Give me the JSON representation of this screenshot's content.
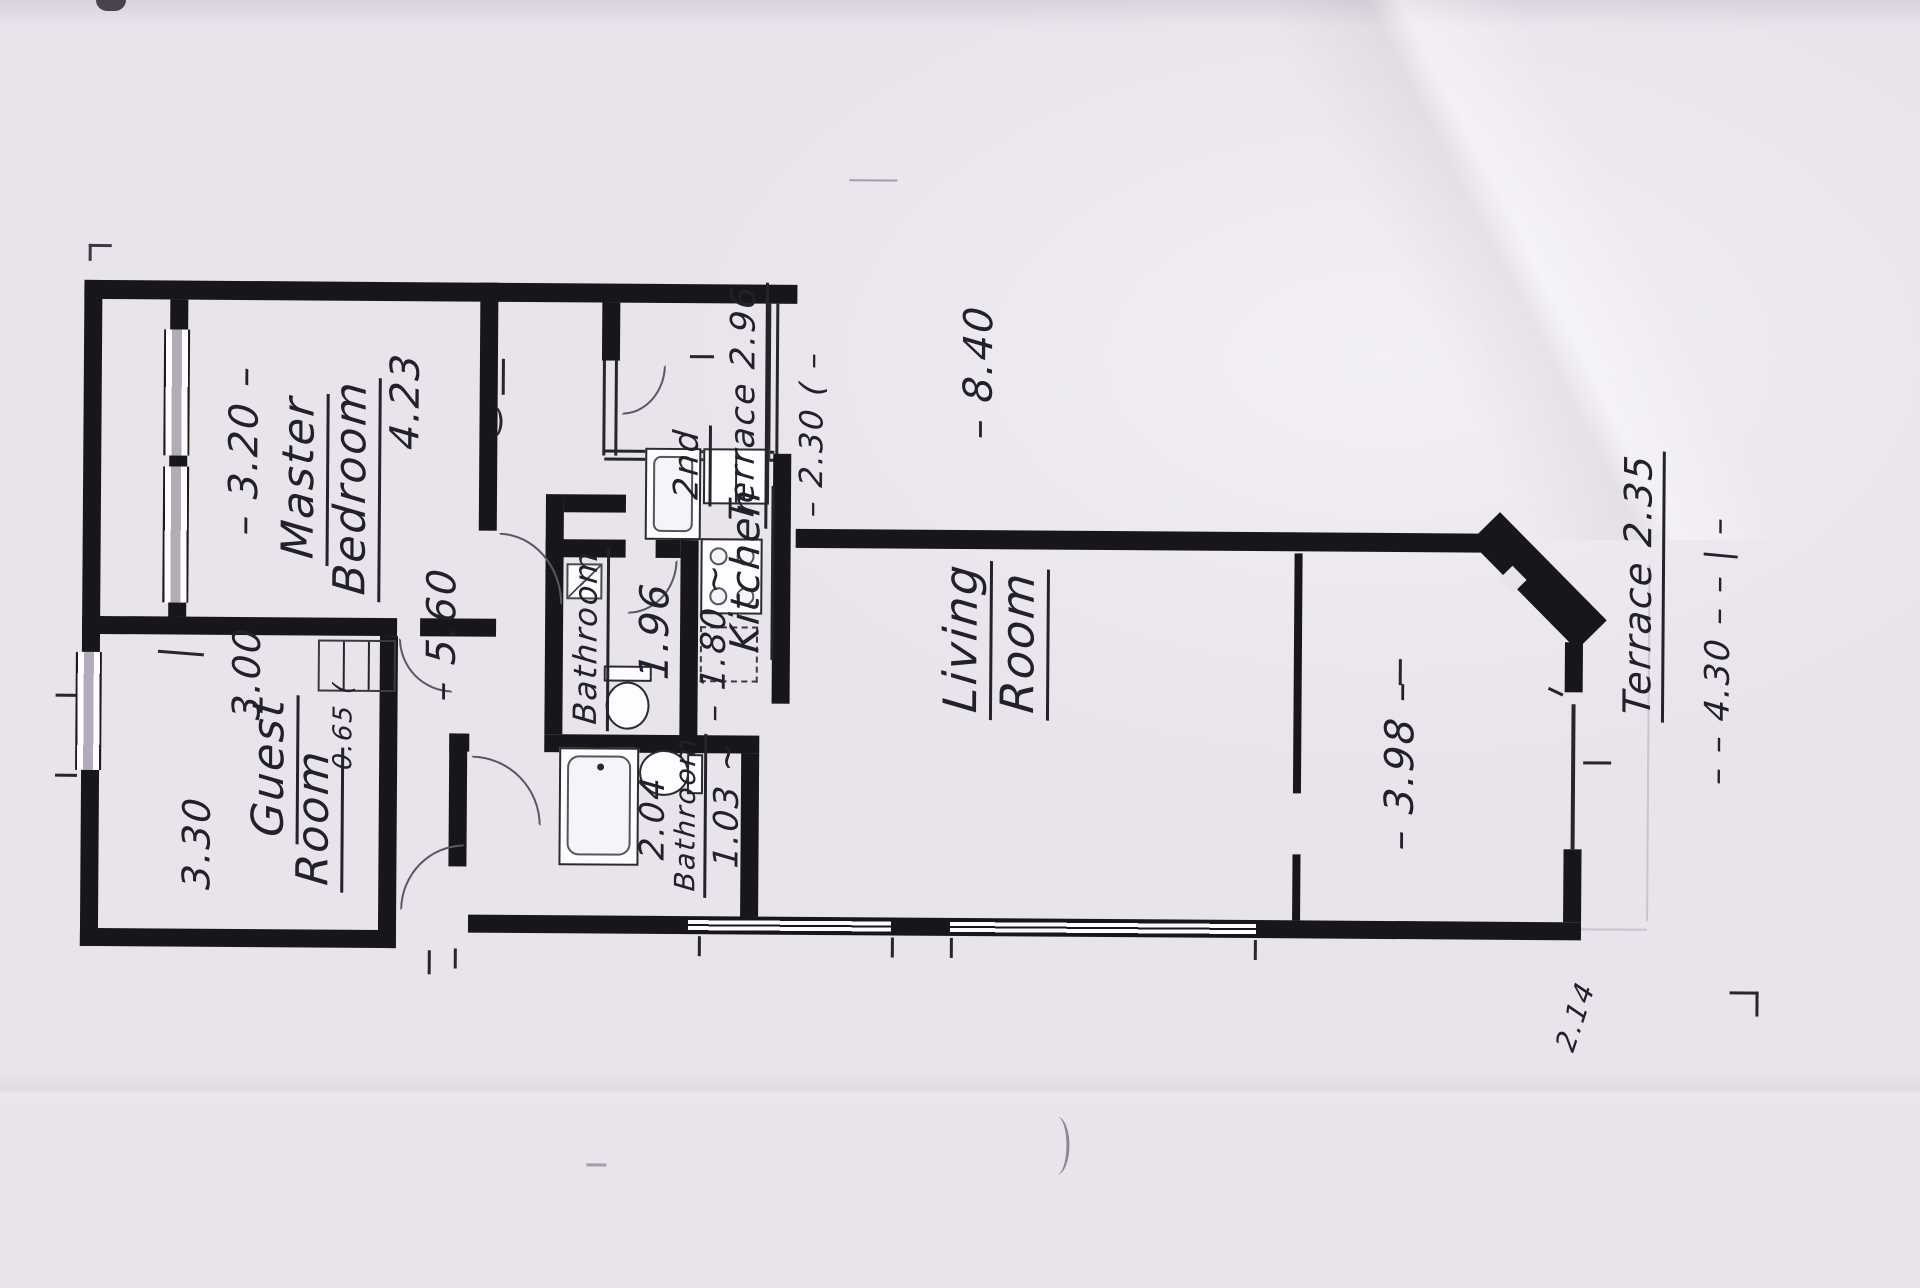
{
  "document": {
    "kind": "hand-drawn apartment floor plan (scanned photo, plan rotated 90°)",
    "paper_color": "#e9e3ec",
    "ink_color": "#21212a",
    "wall_color": "#17171b"
  },
  "rooms": [
    {
      "name": "Master Bedroom",
      "dimensions": [
        "3.20",
        "4.23"
      ]
    },
    {
      "name": "Guest Room",
      "dimensions": [
        "3.00",
        "3.30"
      ]
    },
    {
      "name": "Bathroom",
      "dimensions": [
        "1.96",
        "1.80"
      ]
    },
    {
      "name": "2nd Terrace",
      "dimensions": [
        "2.96",
        "2.30"
      ]
    },
    {
      "name": "Kitchen",
      "dimensions": []
    },
    {
      "name": "Bathroom",
      "dimensions": [
        "2.04",
        "1.03"
      ]
    },
    {
      "name": "Living Room",
      "dimensions": [
        "8.40",
        "3.98"
      ]
    },
    {
      "name": "Terrace",
      "dimensions": [
        "2.35",
        "4.30"
      ]
    }
  ],
  "other_dimensions": [
    "5.60",
    "0.65",
    "2.14"
  ],
  "annotations": [
    {
      "id": "dim-3-20",
      "text": "– 3.20 –",
      "x": 243,
      "y": 455,
      "size": 40,
      "underline": false
    },
    {
      "id": "label-master",
      "text": "Master",
      "x": 300,
      "y": 482,
      "size": 44,
      "underline": true
    },
    {
      "id": "label-bedroom",
      "text": "Bedroom",
      "x": 352,
      "y": 492,
      "size": 44,
      "underline": true
    },
    {
      "id": "dim-4-23",
      "text": "4.23",
      "x": 404,
      "y": 405,
      "size": 40,
      "underline": false
    },
    {
      "id": "dim-3-00",
      "text": "3.00",
      "x": 247,
      "y": 678,
      "size": 38,
      "underline": false
    },
    {
      "id": "label-guest",
      "text": "Guest",
      "x": 272,
      "y": 772,
      "size": 44,
      "underline": true
    },
    {
      "id": "label-guest-room",
      "text": "Room",
      "x": 317,
      "y": 822,
      "size": 44,
      "underline": true
    },
    {
      "id": "dim-3-30",
      "text": "3.30",
      "x": 198,
      "y": 848,
      "size": 38,
      "underline": false
    },
    {
      "id": "dim-0-65",
      "text": "0.65 (",
      "x": 344,
      "y": 730,
      "size": 26,
      "underline": false
    },
    {
      "id": "dim-5-60",
      "text": "– 5.60",
      "x": 442,
      "y": 638,
      "size": 40,
      "underline": false
    },
    {
      "id": "label-bathroom-1",
      "text": "Bathroom",
      "x": 588,
      "y": 640,
      "size": 32,
      "underline": true
    },
    {
      "id": "dim-1-96",
      "text": "1.96",
      "x": 655,
      "y": 633,
      "size": 40,
      "underline": false
    },
    {
      "id": "dim-1-80",
      "text": "– 1.80 ~",
      "x": 714,
      "y": 644,
      "size": 34,
      "underline": false
    },
    {
      "id": "label-2nd",
      "text": "2nd",
      "x": 688,
      "y": 466,
      "size": 34,
      "underline": true
    },
    {
      "id": "label-terrace-2",
      "text": "Terrace 2.96",
      "x": 744,
      "y": 405,
      "size": 34,
      "underline": true
    },
    {
      "id": "dim-2-30",
      "text": "– 2.30 ( –",
      "x": 810,
      "y": 435,
      "size": 32,
      "underline": false
    },
    {
      "id": "label-kitchen",
      "text": "Kitchen",
      "x": 748,
      "y": 572,
      "size": 40,
      "underline": true
    },
    {
      "id": "dim-2-04",
      "text": "2.04",
      "x": 654,
      "y": 820,
      "size": 34,
      "underline": false
    },
    {
      "id": "label-bathroom-2",
      "text": "Bathroom",
      "x": 689,
      "y": 816,
      "size": 28,
      "underline": true
    },
    {
      "id": "dim-1-03",
      "text": "1.03 ~",
      "x": 728,
      "y": 806,
      "size": 34,
      "underline": false
    },
    {
      "id": "dim-8-40",
      "text": "– 8.40",
      "x": 977,
      "y": 372,
      "size": 40,
      "underline": false
    },
    {
      "id": "label-living",
      "text": "Living",
      "x": 963,
      "y": 638,
      "size": 46,
      "underline": true
    },
    {
      "id": "label-living-room",
      "text": "Room",
      "x": 1020,
      "y": 642,
      "size": 46,
      "underline": true
    },
    {
      "id": "dim-3-98",
      "text": "– 3.98 –",
      "x": 1401,
      "y": 762,
      "size": 40,
      "underline": false
    },
    {
      "id": "label-terrace",
      "text": "Terrace 2.35",
      "x": 1640,
      "y": 580,
      "size": 38,
      "underline": true
    },
    {
      "id": "dim-4-30",
      "text": "– – 4.30 – – | –",
      "x": 1718,
      "y": 645,
      "size": 34,
      "underline": false
    },
    {
      "id": "dim-2-14",
      "text": "2.14",
      "x": 1578,
      "y": 1012,
      "size": 28,
      "underline": false,
      "rot": -72
    }
  ]
}
